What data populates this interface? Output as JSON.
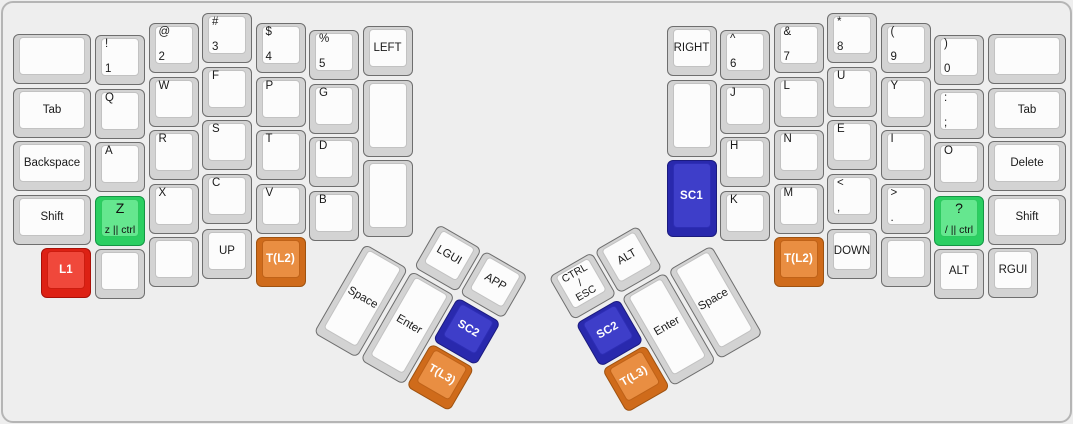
{
  "keyboard": {
    "title": "ergonomic-split-keyboard-layout",
    "background": "#eeeeee",
    "outline_color": "#b5b5b5",
    "palettes": {
      "default": {
        "base": "#d3d3d3",
        "top": "#fcfcfc",
        "border": "#6e6e6e",
        "top_border": "#c2c2c2",
        "text": "#1a1a1a",
        "bold": false
      },
      "green": {
        "base": "#2bcf62",
        "top": "#65e78f",
        "border": "#149544",
        "top_border": "#2dc95f",
        "text": "#111111",
        "bold": false
      },
      "red": {
        "base": "#dd2114",
        "top": "#f0483b",
        "border": "#a81008",
        "top_border": "#cc1d10",
        "text": "#ffffff",
        "bold": true
      },
      "blue": {
        "base": "#2929ad",
        "top": "#3e3ec9",
        "border": "#1b1b7e",
        "top_border": "#2d2db5",
        "text": "#ffffff",
        "bold": true
      },
      "orange": {
        "base": "#cf6b1b",
        "top": "#e98e42",
        "border": "#9e5210",
        "top_border": "#bf6218",
        "text": "#ffffff",
        "bold": true
      }
    },
    "clusters": {
      "left_thumb": {
        "x": 389,
        "y": 194,
        "rotation": 30
      },
      "right_thumb": {
        "x": 684,
        "y": 194,
        "rotation": -30
      }
    },
    "keys": [
      {
        "id": "left-blank-top",
        "x": 10,
        "y": 31,
        "w": 78,
        "labels": {}
      },
      {
        "id": "left-tab",
        "x": 10,
        "y": 84.5,
        "w": 78,
        "labels": {
          "c": "Tab"
        }
      },
      {
        "id": "left-backspace",
        "x": 10,
        "y": 138,
        "w": 78,
        "labels": {
          "c": "Backspace"
        }
      },
      {
        "id": "left-shift",
        "x": 10,
        "y": 191.5,
        "w": 78,
        "labels": {
          "c": "Shift"
        }
      },
      {
        "id": "left-l1",
        "x": 38,
        "y": 245,
        "palette": "red",
        "labels": {
          "c": "L1"
        }
      },
      {
        "id": "left-1",
        "x": 92,
        "y": 32,
        "labels": {
          "tl": "!",
          "bl": "1"
        }
      },
      {
        "id": "left-q",
        "x": 92,
        "y": 85.5,
        "labels": {
          "tl": "Q"
        }
      },
      {
        "id": "left-a",
        "x": 92,
        "y": 139,
        "labels": {
          "tl": "A"
        }
      },
      {
        "id": "left-z-ctrl",
        "x": 92,
        "y": 192.5,
        "palette": "green",
        "labels": {
          "ct": "Z",
          "cb": "z || ctrl"
        }
      },
      {
        "id": "left-blank-bottom-1",
        "x": 92,
        "y": 246,
        "labels": {}
      },
      {
        "id": "left-2",
        "x": 145.5,
        "y": 20,
        "labels": {
          "tl": "@",
          "bl": "2"
        }
      },
      {
        "id": "left-w",
        "x": 145.5,
        "y": 73.5,
        "labels": {
          "tl": "W"
        }
      },
      {
        "id": "left-r",
        "x": 145.5,
        "y": 127,
        "labels": {
          "tl": "R"
        }
      },
      {
        "id": "left-x",
        "x": 145.5,
        "y": 180.5,
        "labels": {
          "tl": "X"
        }
      },
      {
        "id": "left-blank-bottom-2",
        "x": 145.5,
        "y": 234,
        "labels": {}
      },
      {
        "id": "left-3",
        "x": 199,
        "y": 10,
        "labels": {
          "tl": "#",
          "bl": "3"
        }
      },
      {
        "id": "left-f",
        "x": 199,
        "y": 63.5,
        "labels": {
          "tl": "F"
        }
      },
      {
        "id": "left-s",
        "x": 199,
        "y": 117,
        "labels": {
          "tl": "S"
        }
      },
      {
        "id": "left-c",
        "x": 199,
        "y": 170.5,
        "labels": {
          "tl": "C"
        }
      },
      {
        "id": "left-up",
        "x": 199,
        "y": 226,
        "labels": {
          "c": "UP"
        }
      },
      {
        "id": "left-4",
        "x": 252.5,
        "y": 20,
        "labels": {
          "tl": "$",
          "bl": "4"
        }
      },
      {
        "id": "left-p",
        "x": 252.5,
        "y": 73.5,
        "labels": {
          "tl": "P"
        }
      },
      {
        "id": "left-t",
        "x": 252.5,
        "y": 127,
        "labels": {
          "tl": "T"
        }
      },
      {
        "id": "left-v",
        "x": 252.5,
        "y": 180.5,
        "labels": {
          "tl": "V"
        }
      },
      {
        "id": "left-t-l2",
        "x": 252.5,
        "y": 234,
        "palette": "orange",
        "labels": {
          "c": "T(L2)"
        }
      },
      {
        "id": "left-5",
        "x": 306,
        "y": 27,
        "labels": {
          "tl": "%",
          "bl": "5"
        }
      },
      {
        "id": "left-g",
        "x": 306,
        "y": 80.5,
        "labels": {
          "tl": "G"
        }
      },
      {
        "id": "left-d",
        "x": 306,
        "y": 134,
        "labels": {
          "tl": "D"
        }
      },
      {
        "id": "left-b",
        "x": 306,
        "y": 187.5,
        "labels": {
          "tl": "B"
        }
      },
      {
        "id": "left-left-arrow",
        "x": 359.5,
        "y": 23,
        "labels": {
          "c": "LEFT"
        }
      },
      {
        "id": "left-blank-tall-1",
        "x": 359.5,
        "y": 76.5,
        "h": 77,
        "labels": {}
      },
      {
        "id": "left-blank-tall-2",
        "x": 359.5,
        "y": 157,
        "h": 77,
        "labels": {}
      },
      {
        "id": "thumb-left-lgui",
        "cluster": "left_thumb",
        "x": 53.5,
        "y": 0,
        "labels": {
          "c": "LGUI"
        }
      },
      {
        "id": "thumb-left-app",
        "cluster": "left_thumb",
        "x": 107,
        "y": 0,
        "labels": {
          "c": "APP"
        }
      },
      {
        "id": "thumb-left-space",
        "cluster": "left_thumb",
        "x": 0,
        "y": 53.5,
        "h": 103.75,
        "labels": {
          "c": "Space"
        }
      },
      {
        "id": "thumb-left-enter",
        "cluster": "left_thumb",
        "x": 53.5,
        "y": 53.5,
        "h": 103.75,
        "labels": {
          "c": "Enter"
        }
      },
      {
        "id": "thumb-left-sc2",
        "cluster": "left_thumb",
        "x": 107,
        "y": 53.5,
        "palette": "blue",
        "labels": {
          "c": "SC2"
        }
      },
      {
        "id": "thumb-left-t-l3",
        "cluster": "left_thumb",
        "x": 107,
        "y": 107,
        "palette": "orange",
        "labels": {
          "c": "T(L3)"
        }
      },
      {
        "id": "thumb-right-ctrl-esc",
        "cluster": "right_thumb",
        "x": -160.5,
        "y": 0,
        "labels": {
          "lines": [
            "CTRL",
            "/",
            "ESC"
          ]
        }
      },
      {
        "id": "thumb-right-alt",
        "cluster": "right_thumb",
        "x": -107,
        "y": 0,
        "labels": {
          "c": "ALT"
        }
      },
      {
        "id": "thumb-right-sc2",
        "cluster": "right_thumb",
        "x": -160.5,
        "y": 53.5,
        "palette": "blue",
        "labels": {
          "c": "SC2"
        }
      },
      {
        "id": "thumb-right-t-l3",
        "cluster": "right_thumb",
        "x": -160.5,
        "y": 107,
        "palette": "orange",
        "labels": {
          "c": "T(L3)"
        }
      },
      {
        "id": "thumb-right-enter",
        "cluster": "right_thumb",
        "x": -107,
        "y": 53.5,
        "h": 103.75,
        "labels": {
          "c": "Enter"
        }
      },
      {
        "id": "thumb-right-space",
        "cluster": "right_thumb",
        "x": -53.5,
        "y": 53.5,
        "h": 103.75,
        "labels": {
          "c": "Space"
        }
      },
      {
        "id": "right-right-arrow",
        "x": 663.5,
        "y": 23,
        "labels": {
          "c": "RIGHT"
        }
      },
      {
        "id": "right-blank-tall",
        "x": 663.5,
        "y": 76.5,
        "h": 77,
        "labels": {}
      },
      {
        "id": "right-sc1",
        "x": 663.5,
        "y": 157,
        "h": 77,
        "palette": "blue",
        "labels": {
          "c": "SC1"
        }
      },
      {
        "id": "right-6",
        "x": 717,
        "y": 27,
        "labels": {
          "tl": "^",
          "bl": "6"
        }
      },
      {
        "id": "right-j",
        "x": 717,
        "y": 80.5,
        "labels": {
          "tl": "J"
        }
      },
      {
        "id": "right-h",
        "x": 717,
        "y": 134,
        "labels": {
          "tl": "H"
        }
      },
      {
        "id": "right-k",
        "x": 717,
        "y": 187.5,
        "labels": {
          "tl": "K"
        }
      },
      {
        "id": "right-7",
        "x": 770.5,
        "y": 20,
        "labels": {
          "tl": "&",
          "bl": "7"
        }
      },
      {
        "id": "right-l",
        "x": 770.5,
        "y": 73.5,
        "labels": {
          "tl": "L"
        }
      },
      {
        "id": "right-n",
        "x": 770.5,
        "y": 127,
        "labels": {
          "tl": "N"
        }
      },
      {
        "id": "right-m",
        "x": 770.5,
        "y": 180.5,
        "labels": {
          "tl": "M"
        }
      },
      {
        "id": "right-t-l2",
        "x": 770.5,
        "y": 234,
        "palette": "orange",
        "labels": {
          "c": "T(L2)"
        }
      },
      {
        "id": "right-8",
        "x": 824,
        "y": 10,
        "labels": {
          "tl": "*",
          "bl": "8"
        }
      },
      {
        "id": "right-u",
        "x": 824,
        "y": 63.5,
        "labels": {
          "tl": "U"
        }
      },
      {
        "id": "right-e",
        "x": 824,
        "y": 117,
        "labels": {
          "tl": "E"
        }
      },
      {
        "id": "right-comma",
        "x": 824,
        "y": 170.5,
        "labels": {
          "tl": "<",
          "bl": ","
        }
      },
      {
        "id": "right-down",
        "x": 824,
        "y": 226,
        "labels": {
          "c": "DOWN"
        }
      },
      {
        "id": "right-9",
        "x": 877.5,
        "y": 20,
        "labels": {
          "tl": "(",
          "bl": "9"
        }
      },
      {
        "id": "right-y",
        "x": 877.5,
        "y": 73.5,
        "labels": {
          "tl": "Y"
        }
      },
      {
        "id": "right-i",
        "x": 877.5,
        "y": 127,
        "labels": {
          "tl": "I"
        }
      },
      {
        "id": "right-period",
        "x": 877.5,
        "y": 180.5,
        "labels": {
          "tl": ">",
          "bl": "."
        }
      },
      {
        "id": "right-blank-bottom",
        "x": 877.5,
        "y": 234,
        "labels": {}
      },
      {
        "id": "right-0",
        "x": 931,
        "y": 32,
        "labels": {
          "tl": ")",
          "bl": "0"
        }
      },
      {
        "id": "right-semicolon",
        "x": 931,
        "y": 85.5,
        "labels": {
          "tl": ":",
          "bl": ";"
        }
      },
      {
        "id": "right-o",
        "x": 931,
        "y": 139,
        "labels": {
          "tl": "O"
        }
      },
      {
        "id": "right-question-ctrl",
        "x": 931,
        "y": 192.5,
        "palette": "green",
        "labels": {
          "ct": "?",
          "cb": "/ || ctrl"
        }
      },
      {
        "id": "right-alt",
        "x": 931,
        "y": 246,
        "labels": {
          "c": "ALT"
        }
      },
      {
        "id": "right-blank-top",
        "x": 985,
        "y": 31,
        "w": 78,
        "labels": {}
      },
      {
        "id": "right-tab",
        "x": 985,
        "y": 84.5,
        "w": 78,
        "labels": {
          "c": "Tab"
        }
      },
      {
        "id": "right-delete",
        "x": 985,
        "y": 138,
        "w": 78,
        "labels": {
          "c": "Delete"
        }
      },
      {
        "id": "right-shift",
        "x": 985,
        "y": 191.5,
        "w": 78,
        "labels": {
          "c": "Shift"
        }
      },
      {
        "id": "right-rgui",
        "x": 985,
        "y": 245,
        "labels": {
          "c": "RGUI"
        }
      }
    ]
  }
}
